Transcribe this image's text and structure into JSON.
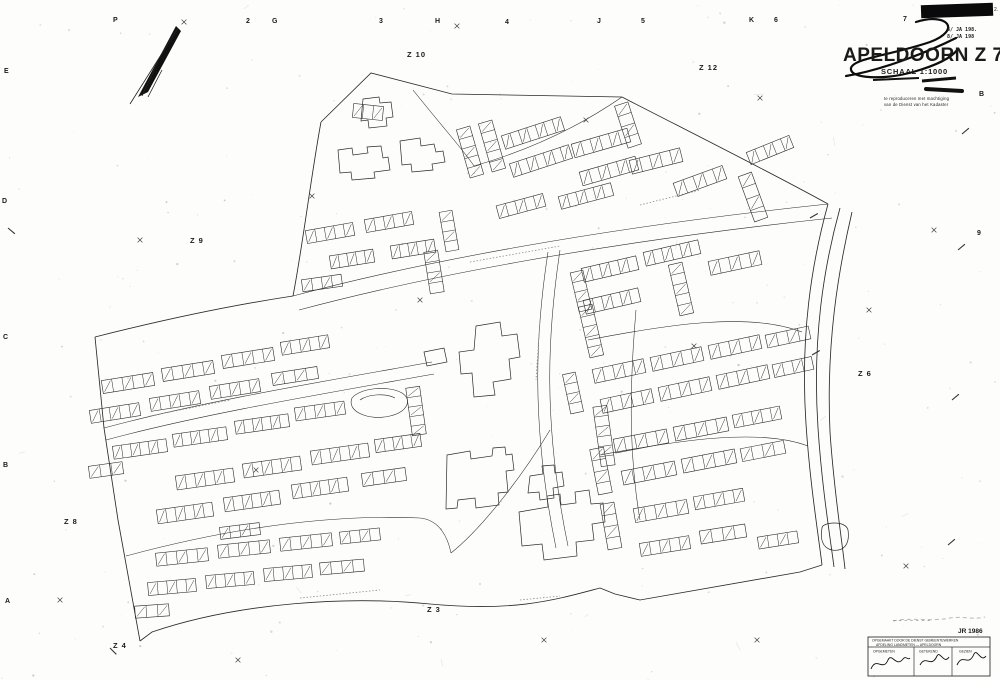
{
  "sheet": {
    "title": "APELDOORN Z 7",
    "scale_label": "SCHAAL 1:1000",
    "stamp_line1": "8/ JA 198.",
    "stamp_line2": "8/ JA 198",
    "corner_mark": "2.",
    "fine_print_line1": "te reproduceren met machtiging",
    "fine_print_line2": "van de Dienst van het Kadaster",
    "year_label": "JR 1986",
    "faint_note": "– – – – – – –"
  },
  "approval_table": {
    "header_line1": "OPGEMAAKT DOOR DE DIENST GEMEENTEWERKEN",
    "header_line2": "AFDELING LANDMETEN  —  APELDOORN",
    "columns": [
      {
        "label": "OPGEMETEN"
      },
      {
        "label": "GETEKEND"
      },
      {
        "label": "GEZIEN"
      }
    ]
  },
  "grid_refs": {
    "top": [
      {
        "text": "P",
        "x": 113,
        "y": 22
      },
      {
        "text": "2",
        "x": 246,
        "y": 23
      },
      {
        "text": "G",
        "x": 272,
        "y": 23
      },
      {
        "text": "3",
        "x": 379,
        "y": 23
      },
      {
        "text": "H",
        "x": 435,
        "y": 23
      },
      {
        "text": "4",
        "x": 505,
        "y": 24
      },
      {
        "text": "J",
        "x": 597,
        "y": 23
      },
      {
        "text": "5",
        "x": 641,
        "y": 23
      },
      {
        "text": "K",
        "x": 749,
        "y": 22
      },
      {
        "text": "6",
        "x": 774,
        "y": 22
      },
      {
        "text": "7",
        "x": 903,
        "y": 21
      }
    ],
    "left": [
      {
        "text": "E",
        "x": 4,
        "y": 73
      },
      {
        "text": "D",
        "x": 2,
        "y": 203
      },
      {
        "text": "C",
        "x": 3,
        "y": 339
      },
      {
        "text": "B",
        "x": 3,
        "y": 467
      },
      {
        "text": "A",
        "x": 5,
        "y": 603
      }
    ],
    "right": [
      {
        "text": "B",
        "x": 979,
        "y": 96
      },
      {
        "text": "9",
        "x": 977,
        "y": 235
      }
    ]
  },
  "zone_labels": [
    {
      "text": "Z 10",
      "x": 407,
      "y": 57
    },
    {
      "text": "Z 12",
      "x": 699,
      "y": 70
    },
    {
      "text": "Z 9",
      "x": 190,
      "y": 243
    },
    {
      "text": "Z 6",
      "x": 858,
      "y": 376
    },
    {
      "text": "Z 8",
      "x": 64,
      "y": 524
    },
    {
      "text": "Z 3",
      "x": 427,
      "y": 612
    },
    {
      "text": "Z 4",
      "x": 113,
      "y": 648
    }
  ],
  "colors": {
    "ink": "#2a2a2a",
    "faint": "#999999",
    "paper": "#fdfdfc",
    "bar": "#0a0a0a"
  },
  "map": {
    "boundaries": [
      "M321,122 L371,73 L452,94 L622,97",
      "M622,97 C690,132 770,172 828,204",
      "M828,204 C812,262 800,334 806,424 C810,484 818,532 822,565",
      "M840,208 C824,266 812,338 818,428 C822,488 830,536 834,567",
      "M852,212 C838,272 826,344 830,432 C834,492 842,540 845,569",
      "M822,565 L800,572 L640,600 L615,594 L600,588",
      "M600,588 C555,600 515,612 430,604 C350,596 240,602 152,632 L140,641",
      "M140,641 L118,520 L104,428 L95,337",
      "M95,337 C170,318 240,304 293,296",
      "M293,296 C302,250 312,170 321,122"
    ],
    "roads": [
      "M293,296 C420,262 600,228 828,204",
      "M299,310 C426,276 606,242 832,218",
      "M548,252 C536,330 530,420 556,548",
      "M560,250 C548,330 542,420 568,546",
      "M104,428 C200,402 320,382 432,362",
      "M106,440 C202,414 322,394 434,374",
      "M126,556 C230,528 330,514 420,518 C440,520 448,538 451,553",
      "M550,430 C520,480 480,530 451,553",
      "M413,90 C445,130 465,152 474,166",
      "M474,166 C530,150 580,126 622,97",
      "M588,340 C670,324 750,312 802,332",
      "M600,455 C680,440 760,428 808,446",
      "M636,310 C630,380 628,450 640,520"
    ],
    "buildings_large": [
      "M363,99 L379,97 L380,103 L391,102 L393,117 L386,118 L387,126 L369,128 L368,120 L361,121 Z",
      "M338,150 L352,148 L353,155 L368,153 L367,147 L381,146 L383,158 L388,157 L390,170 L374,172 L375,178 L352,180 L351,172 L340,173 Z",
      "M400,141 L420,138 L421,146 L434,144 L436,152 L443,151 L445,162 L432,164 L433,170 L412,172 L411,164 L402,165 Z",
      "M476,326 L500,322 L502,336 L517,334 L520,357 L509,359 L511,379 L493,382 L495,395 L474,397 L472,373 L461,374 L459,352 L474,350 Z",
      "M424,352 L444,348 L447,362 L427,366 Z",
      "M447,455 L470,451 L471,459 L492,456 L493,448 L505,447 L506,455 L512,454 L514,470 L506,471 L508,492 L498,493 L499,505 L476,508 L475,498 L458,500 L457,508 L446,509 Z",
      "M530,476 L543,474 L542,466 L554,465 L555,473 L562,472 L564,486 L553,488 L554,498 L540,500 L539,492 L528,493 Z",
      "M519,512 L548,507 L547,496 L560,494 L561,505 L576,503 L575,492 L589,490 L591,504 L603,503 L605,522 L592,524 L594,540 L576,542 L577,556 L544,560 L542,544 L522,546 Z",
      "M822,528 C822,522 846,520 848,530 C850,544 844,552 832,550 C822,548 820,538 822,528 Z"
    ],
    "pond": [
      "M352,398 C360,388 388,385 402,393 C413,400 407,412 390,416 C370,421 346,412 352,398 Z",
      "M360,400 C368,394 386,393 395,398"
    ],
    "rows": [
      [
        368,
        112,
        30,
        14,
        6,
        3
      ],
      [
        470,
        152,
        14,
        50,
        -16,
        5
      ],
      [
        492,
        146,
        14,
        50,
        -16,
        5
      ],
      [
        533,
        133,
        62,
        14,
        -18,
        7
      ],
      [
        541,
        161,
        62,
        14,
        -18,
        7
      ],
      [
        601,
        143,
        58,
        14,
        -16,
        6
      ],
      [
        609,
        171,
        58,
        14,
        -16,
        6
      ],
      [
        656,
        161,
        52,
        14,
        -14,
        5
      ],
      [
        628,
        125,
        14,
        44,
        -18,
        4
      ],
      [
        586,
        196,
        54,
        13,
        -15,
        6
      ],
      [
        521,
        206,
        48,
        13,
        -15,
        5
      ],
      [
        700,
        181,
        52,
        14,
        -20,
        5
      ],
      [
        753,
        197,
        14,
        48,
        -20,
        4
      ],
      [
        770,
        150,
        46,
        13,
        -22,
        5
      ],
      [
        330,
        233,
        48,
        13,
        -10,
        5
      ],
      [
        389,
        222,
        48,
        13,
        -10,
        5
      ],
      [
        352,
        259,
        44,
        13,
        -9,
        5
      ],
      [
        413,
        249,
        44,
        13,
        -9,
        5
      ],
      [
        322,
        283,
        40,
        12,
        -8,
        4
      ],
      [
        434,
        272,
        14,
        42,
        -9,
        4
      ],
      [
        449,
        231,
        13,
        40,
        -10,
        4
      ],
      [
        128,
        383,
        52,
        13,
        -9,
        5
      ],
      [
        188,
        371,
        52,
        13,
        -9,
        5
      ],
      [
        248,
        358,
        52,
        13,
        -9,
        5
      ],
      [
        305,
        345,
        48,
        13,
        -9,
        5
      ],
      [
        115,
        413,
        50,
        13,
        -9,
        5
      ],
      [
        175,
        401,
        50,
        13,
        -9,
        5
      ],
      [
        235,
        389,
        50,
        13,
        -9,
        5
      ],
      [
        295,
        376,
        46,
        12,
        -9,
        4
      ],
      [
        140,
        449,
        54,
        13,
        -8,
        6
      ],
      [
        200,
        437,
        54,
        13,
        -8,
        6
      ],
      [
        262,
        424,
        54,
        13,
        -8,
        6
      ],
      [
        320,
        411,
        50,
        13,
        -8,
        5
      ],
      [
        106,
        470,
        34,
        12,
        -8,
        3
      ],
      [
        205,
        479,
        58,
        14,
        -8,
        6
      ],
      [
        272,
        467,
        58,
        14,
        -8,
        6
      ],
      [
        340,
        454,
        58,
        14,
        -8,
        6
      ],
      [
        398,
        443,
        46,
        13,
        -8,
        5
      ],
      [
        185,
        513,
        56,
        14,
        -8,
        6
      ],
      [
        252,
        501,
        56,
        14,
        -8,
        6
      ],
      [
        320,
        488,
        56,
        14,
        -8,
        6
      ],
      [
        384,
        477,
        44,
        13,
        -8,
        4
      ],
      [
        416,
        411,
        14,
        48,
        -8,
        5
      ],
      [
        240,
        531,
        40,
        12,
        -7,
        4
      ],
      [
        182,
        557,
        52,
        13,
        -6,
        5
      ],
      [
        244,
        549,
        52,
        13,
        -6,
        5
      ],
      [
        306,
        542,
        52,
        13,
        -6,
        5
      ],
      [
        360,
        536,
        40,
        12,
        -6,
        4
      ],
      [
        172,
        587,
        48,
        13,
        -5,
        5
      ],
      [
        230,
        580,
        48,
        13,
        -5,
        5
      ],
      [
        288,
        573,
        48,
        13,
        -5,
        5
      ],
      [
        342,
        567,
        44,
        12,
        -5,
        4
      ],
      [
        152,
        611,
        34,
        12,
        -4,
        3
      ],
      [
        610,
        269,
        56,
        14,
        -13,
        6
      ],
      [
        672,
        253,
        56,
        14,
        -13,
        6
      ],
      [
        735,
        263,
        52,
        14,
        -12,
        5
      ],
      [
        612,
        301,
        56,
        14,
        -13,
        6
      ],
      [
        681,
        289,
        14,
        52,
        -13,
        5
      ],
      [
        591,
        331,
        14,
        52,
        -13,
        5
      ],
      [
        619,
        371,
        52,
        14,
        -12,
        5
      ],
      [
        677,
        359,
        52,
        14,
        -12,
        5
      ],
      [
        735,
        347,
        52,
        14,
        -12,
        5
      ],
      [
        788,
        337,
        44,
        13,
        -12,
        4
      ],
      [
        627,
        401,
        52,
        14,
        -12,
        5
      ],
      [
        685,
        389,
        52,
        14,
        -12,
        5
      ],
      [
        743,
        377,
        52,
        14,
        -12,
        5
      ],
      [
        793,
        367,
        40,
        13,
        -12,
        4
      ],
      [
        641,
        441,
        54,
        14,
        -11,
        5
      ],
      [
        701,
        429,
        54,
        14,
        -11,
        5
      ],
      [
        757,
        417,
        48,
        13,
        -11,
        5
      ],
      [
        649,
        473,
        54,
        14,
        -11,
        5
      ],
      [
        709,
        461,
        54,
        14,
        -11,
        5
      ],
      [
        763,
        451,
        44,
        13,
        -11,
        4
      ],
      [
        661,
        511,
        54,
        14,
        -10,
        5
      ],
      [
        719,
        499,
        50,
        13,
        -10,
        5
      ],
      [
        665,
        546,
        50,
        13,
        -9,
        5
      ],
      [
        723,
        534,
        46,
        13,
        -9,
        4
      ],
      [
        611,
        526,
        14,
        46,
        -10,
        4
      ],
      [
        601,
        471,
        14,
        46,
        -11,
        4
      ],
      [
        581,
        291,
        13,
        40,
        -13,
        4
      ],
      [
        573,
        393,
        13,
        40,
        -12,
        4
      ],
      [
        604,
        436,
        14,
        60,
        -8,
        6
      ],
      [
        778,
        540,
        40,
        12,
        -9,
        4
      ]
    ],
    "crosses": [
      [
        140,
        240
      ],
      [
        312,
        196
      ],
      [
        457,
        26
      ],
      [
        586,
        120
      ],
      [
        760,
        98
      ],
      [
        934,
        230
      ],
      [
        694,
        346
      ],
      [
        256,
        470
      ],
      [
        420,
        300
      ],
      [
        544,
        640
      ],
      [
        757,
        640
      ],
      [
        906,
        566
      ],
      [
        60,
        600
      ],
      [
        184,
        22
      ],
      [
        869,
        310
      ],
      [
        238,
        660
      ]
    ],
    "ticks": [
      [
        962,
        134,
        -40
      ],
      [
        958,
        250,
        -40
      ],
      [
        952,
        400,
        -40
      ],
      [
        948,
        545,
        -40
      ],
      [
        8,
        228,
        40
      ],
      [
        810,
        218,
        -30
      ],
      [
        812,
        355,
        -30
      ],
      [
        110,
        648,
        45
      ]
    ],
    "name_squiggles": [
      "M470,262 L560,246",
      "M150,416 L230,400",
      "M300,598 L380,590",
      "M540,320 L536,380",
      "M520,600 L560,596",
      "M640,205 L700,190"
    ],
    "north_arrow": {
      "needle": "176,26 181,31 148,92 138,97",
      "strokes": [
        "M130,104 L178,28",
        "M142,96 L158,62",
        "M148,97 L162,70"
      ]
    },
    "signature_title": [
      "M916,22 C948,12 962,30 930,42 C892,55 854,58 851,68 C849,79 884,80 913,72 C938,65 952,57 957,50",
      "M846,76 C884,70 932,50 956,38"
    ],
    "signatures_table": [
      "M871,669 C876,656 883,672 888,660 C892,652 896,668 903,659 C906,655 908,661 910,658",
      "M920,665 C926,654 931,669 937,656 C940,650 944,665 949,657",
      "M957,665 C963,652 968,668 974,654 C977,648 981,663 986,656"
    ],
    "faint_squiggle": "M893,621 C910,617 930,622 950,618 C962,616 975,620 985,617"
  }
}
